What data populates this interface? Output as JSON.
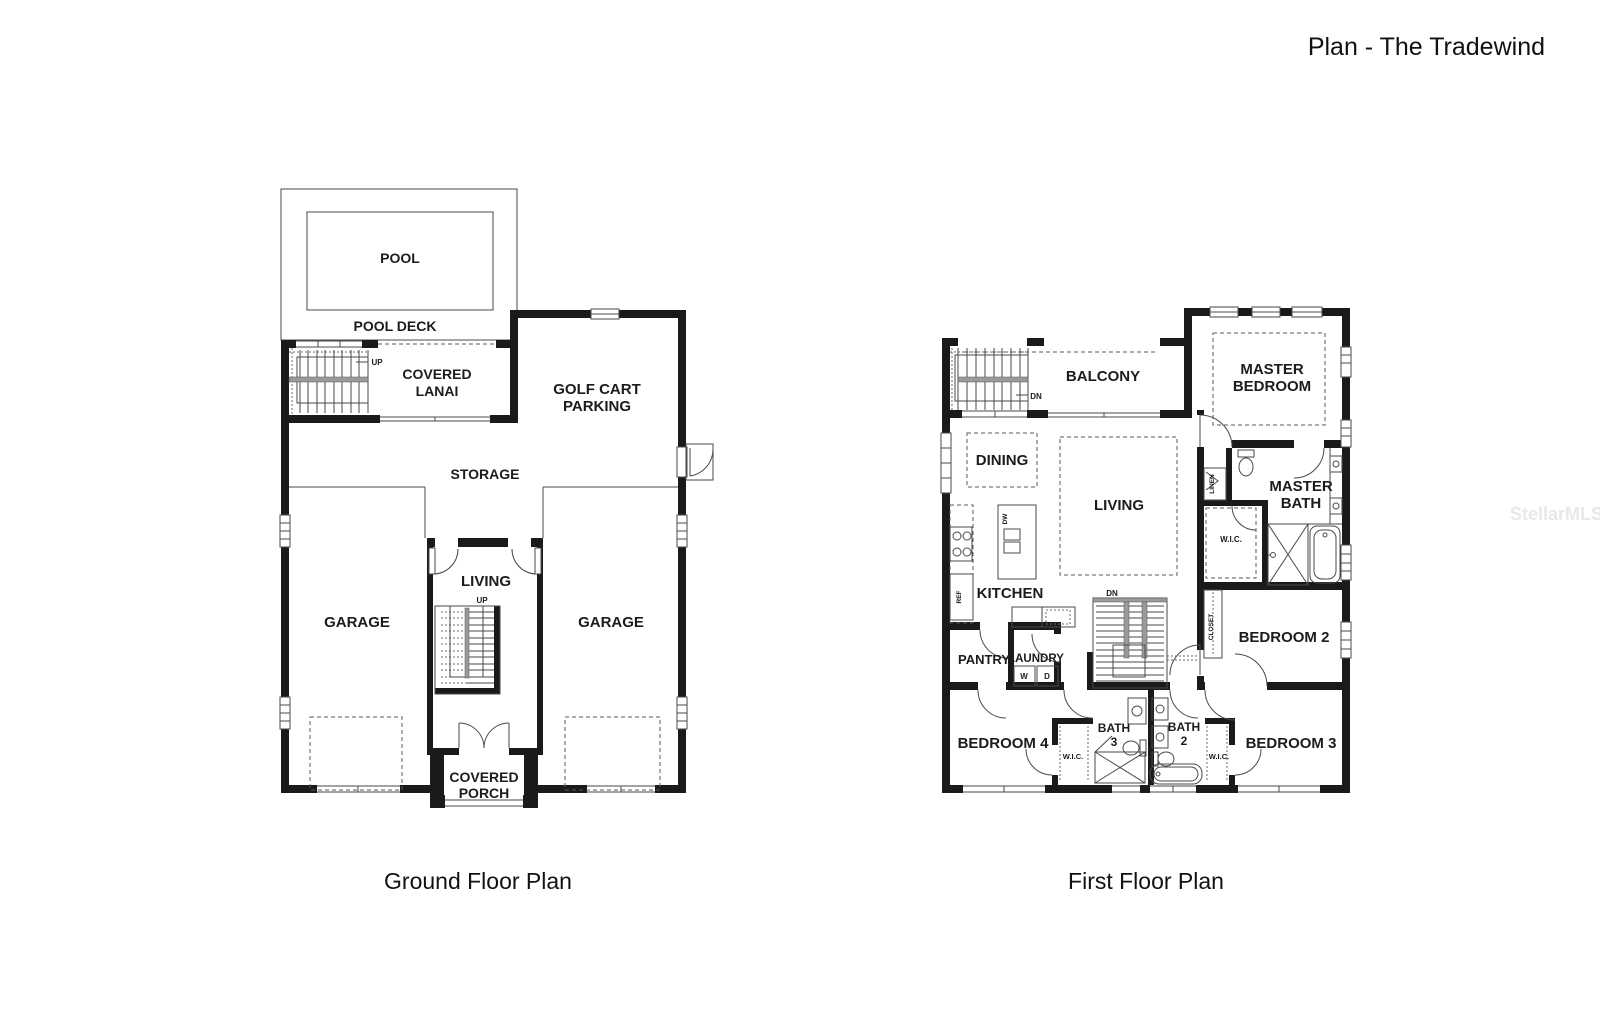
{
  "page": {
    "title": "Plan - The Tradewind",
    "watermark": "StellarMLS"
  },
  "ground_floor": {
    "caption": "Ground Floor Plan",
    "labels": {
      "pool": "POOL",
      "pool_deck": "POOL DECK",
      "stairs_up": "UP",
      "covered_lanai_1": "COVERED",
      "covered_lanai_2": "LANAI",
      "golf_cart_1": "GOLF CART",
      "golf_cart_2": "PARKING",
      "storage": "STORAGE",
      "garage_left": "GARAGE",
      "garage_right": "GARAGE",
      "living": "LIVING",
      "stairs_up_center": "UP",
      "covered_porch_1": "COVERED",
      "covered_porch_2": "PORCH"
    }
  },
  "first_floor": {
    "caption": "First Floor Plan",
    "labels": {
      "stairs_dn": "DN",
      "balcony": "BALCONY",
      "master_bedroom_1": "MASTER",
      "master_bedroom_2": "BEDROOM",
      "dining": "DINING",
      "living": "LIVING",
      "linen": "LINEN",
      "master_bath_1": "MASTER",
      "master_bath_2": "BATH",
      "wic_master": "W.I.C.",
      "kitchen": "KITCHEN",
      "ref": "REF",
      "dw": "DW",
      "closet": "CLOSET",
      "stairs_dn_center": "DN",
      "pantry": "PANTRY",
      "laundry": "LAUNDRY",
      "washer": "W",
      "dryer": "D",
      "bedroom_2": "BEDROOM 2",
      "bedroom_4": "BEDROOM 4",
      "wic_bedroom4": "W.I.C.",
      "bath3_1": "BATH",
      "bath3_2": "3",
      "bath2_1": "BATH",
      "bath2_2": "2",
      "wic_bedroom3": "W.I.C.",
      "bedroom_3": "BEDROOM 3"
    }
  }
}
